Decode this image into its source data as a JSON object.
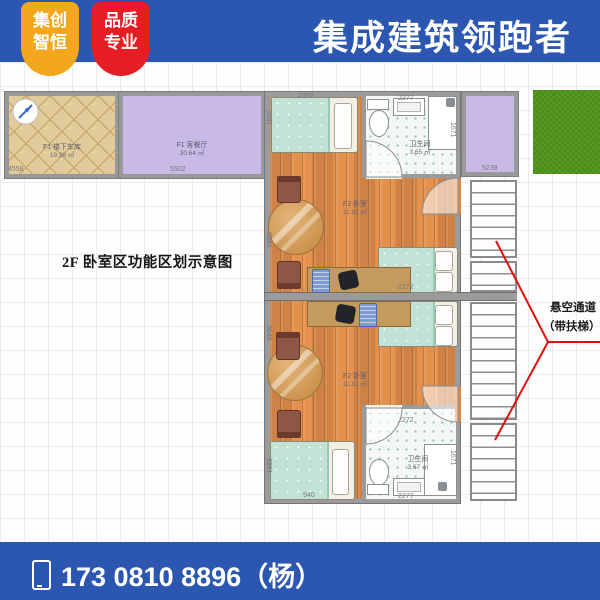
{
  "header": {
    "badge_left": {
      "line1": "集创",
      "line2": "智恒"
    },
    "badge_right": {
      "line1": "品质",
      "line2": "专业"
    },
    "title": "集成建筑领跑者"
  },
  "plan": {
    "caption": "2F 卧室区功能区划示意图",
    "rooms": {
      "garage": {
        "name": "F1 楼下车库",
        "area": "19.38 ㎡"
      },
      "living": {
        "name": "F1 客餐厅",
        "area": "30.64 ㎡"
      },
      "bedroom_top": {
        "name": "F2 卧室",
        "area": "11.81 ㎡"
      },
      "bedroom_bottom": {
        "name": "F2 卧室",
        "area": "11.81 ㎡"
      },
      "bath_top": {
        "name": "卫生间",
        "area": "3.65 ㎡"
      },
      "bath_bottom": {
        "name": "卫生间",
        "area": "3.67 ㎡"
      }
    },
    "dims": {
      "garage_w": "4558",
      "living_w": "5502",
      "terrace_w": "5238",
      "bath_top_w": "2277",
      "mid_w": "2272",
      "bath_bottom_w1": "2272",
      "bath_bottom_w2": "2277",
      "bath_top_h": "1671",
      "bath_bottom_h": "1671",
      "bed_top_w": "2350",
      "bed_bottom_w": "940",
      "wall_left_h1": "3391",
      "wall_left_h2": "3046",
      "wall_left_h3": "3046",
      "wall_left_h4": "3391"
    },
    "annotation": {
      "line1": "悬空通道",
      "line2": "（带扶梯）"
    }
  },
  "footer": {
    "phone": "173 0810 8896（杨）"
  },
  "colors": {
    "brand_blue": "#2b57b0",
    "badge_yellow": "#f2a71c",
    "badge_red": "#e71d24",
    "annotation_red": "#dd1111",
    "grass_green": "#4f9419",
    "floor_wood": "#db8a49",
    "room_purple": "#c9b9e6",
    "tile_tan": "#e2cb9a",
    "blanket_teal": "#c3e2d6"
  }
}
